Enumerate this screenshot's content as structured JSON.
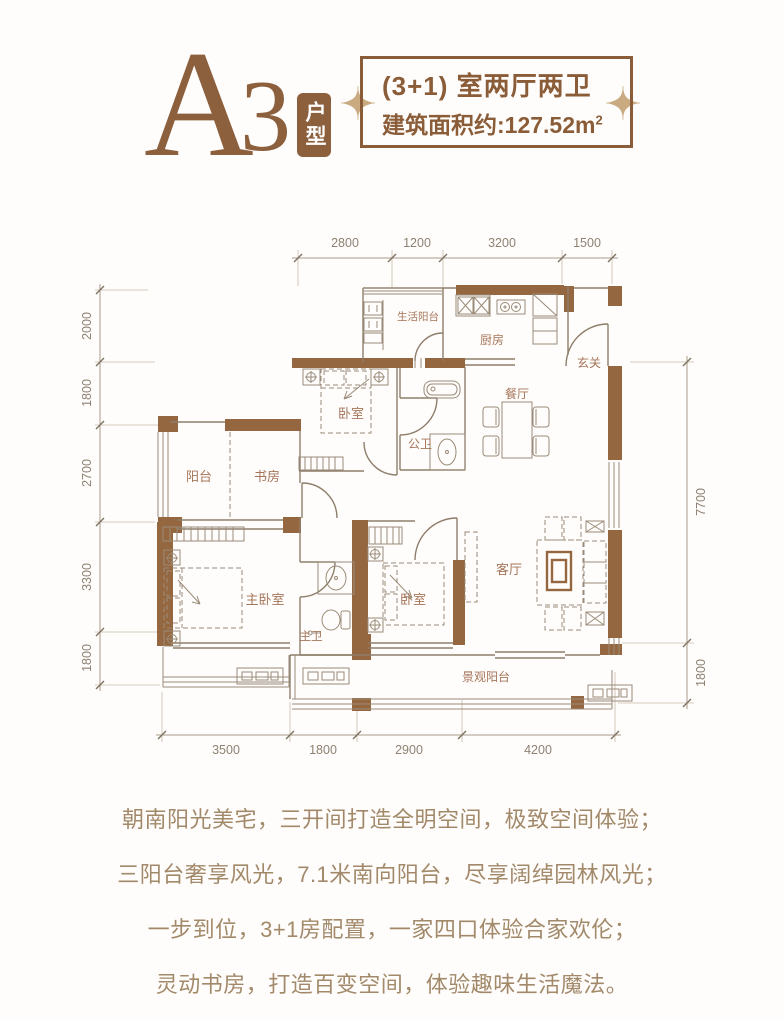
{
  "header": {
    "title_letter": "A",
    "title_number": "3",
    "title_badge": "户型"
  },
  "info_box": {
    "spec_line": "(3+1) 室两厅两卫",
    "area_text": "建筑面积约:127.52m",
    "area_sup": "2"
  },
  "floorplan": {
    "rooms": {
      "service_balcony": "生活阳台",
      "kitchen": "厨房",
      "entry": "玄关",
      "dining": "餐厅",
      "bedroom_top": "卧室",
      "public_bath": "公卫",
      "balcony": "阳台",
      "study": "书房",
      "master_bedroom": "主卧室",
      "master_bath": "主卫",
      "bedroom_right": "卧室",
      "living_room": "客厅",
      "view_balcony": "景观阳台"
    },
    "dims": {
      "top": [
        "2800",
        "1200",
        "3200",
        "1500"
      ],
      "left": [
        "2000",
        "1800",
        "2700",
        "3300",
        "1800"
      ],
      "right": [
        "7700",
        "1800"
      ],
      "bottom": [
        "3500",
        "1800",
        "2900",
        "4200"
      ]
    }
  },
  "marketing": {
    "lines": [
      "朝南阳光美宅，三开间打造全明空间，极致空间体验；",
      "三阳台奢享风光，7.1米南向阳台，尽享阔绰园林风光；",
      "一步到位，3+1房配置，一家四口体验合家欢伦；",
      "灵动书房，打造百变空间，体验趣味生活魔法。"
    ]
  },
  "colors": {
    "wall_brown": "#956740",
    "accent_brown": "#8a5c38",
    "marketing_text": "#a2896a",
    "sparkle": "#c9aa81"
  }
}
